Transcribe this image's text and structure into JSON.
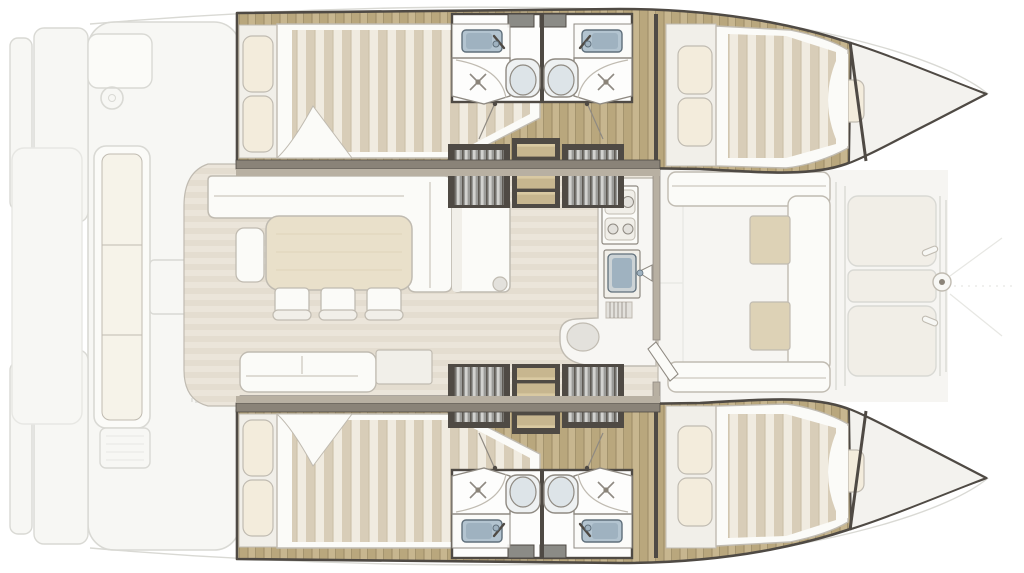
{
  "diagram": {
    "title": "Catamaran interior layout — top-view floor plan, bow to the right",
    "type": "boat-floor-plan"
  },
  "areas": {
    "aft_cockpit": {
      "label": "Aft cockpit — bench sofa, helm seat, steering wheel, table, grill, swim platforms"
    },
    "salon": {
      "label": "Salon & galley — L-shaped sofa, dining table, 3 chairs, side bench, aft sofa, chart desk, galley island, 4-burner stove, sink, curved counter"
    },
    "port_hull": {
      "label": "Port hull — aft double cabin, washbasin, shower, toilet, companionway steps, forward double cabin, forepeak"
    },
    "starboard_hull": {
      "label": "Starboard hull — aft double cabin, washbasin, shower, toilet, companionway steps, forward double cabin, forepeak"
    },
    "forward_cockpit": {
      "label": "Forward cockpit — U-shaped seating with two tables"
    },
    "foredeck": {
      "label": "Foredeck — two sun pads, forestay fitting, mooring cleats"
    }
  },
  "colors": {
    "white": "#ffffff",
    "exterior": "#f7f7f4",
    "exteriorLine": "#d9d9d4",
    "faintLine": "#e7e7e3",
    "deckFloor": "#f6f5f2",
    "padFill": "#f1eee7",
    "cushionBeige": "#ddd2b6",
    "upholstery": "#fbfbf8",
    "upholsteryShade": "#f1efe9",
    "furnitureLine": "#c0bbb1",
    "pillow": "#f3ecdc",
    "mattressBase": "#f0ebe0",
    "mattressDark": "#d8cdb8",
    "mattressLine": "#c7bba2",
    "tableWood": "#e9e0ca",
    "wood": "#c7b68f",
    "woodDark": "#b9a77d",
    "woodLine": "#9c8b66",
    "salonFloor": "#ebe5da",
    "salonFloorDark": "#e4ddd0",
    "bathFloor": "#fdfdfc",
    "sinkBlue": "#b3c4d0",
    "sinkBlueDark": "#9fb2c0",
    "sinkEdge": "#5f6f7b",
    "toilet": "#eef1f2",
    "toiletSeat": "#dde4e8",
    "fixtureLine": "#8f8a82",
    "wall": "#4f4a44",
    "wallLight": "#8a8378",
    "trimLight": "#b8b0a2",
    "hatch": "#8b8b86",
    "counter": "#f7f6f3",
    "basin": "#ccd3d6",
    "stool": "#e3e1dc",
    "forepeakFloor": "#f3f2ee",
    "slat": "#9b9b98",
    "slatHi": "#d2d2cf",
    "slatShadow": "#5e5a54",
    "treadHi": "#d9c9a2"
  }
}
